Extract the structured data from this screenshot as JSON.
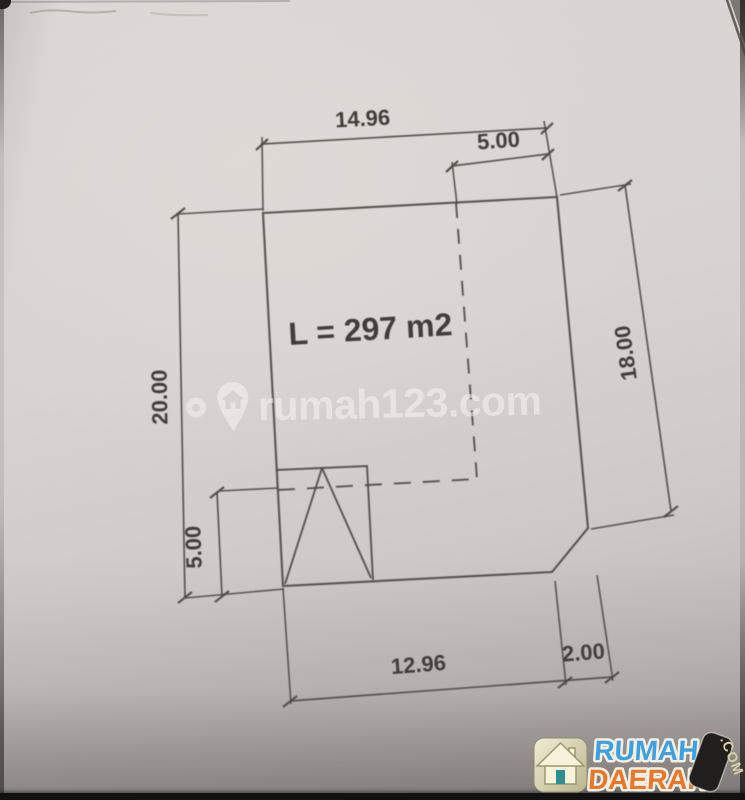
{
  "document": {
    "kind": "land-plot-technical-drawing-photo",
    "area_label": "L = 297 m2",
    "dimensions": {
      "top_width": "14.96",
      "top_right_inset": "5.00",
      "left_side": "20.00",
      "right_side": "18.00",
      "lower_left_height": "5.00",
      "bottom_width": "12.96",
      "bottom_chamfer": "2.00"
    }
  },
  "watermark": {
    "text": "rumah123.com",
    "icon": "map-pin-house-icon",
    "color": "rgba(250,248,246,0.50)"
  },
  "branding": {
    "badge_icon": "house-icon",
    "line1": "RUMAH",
    "line2": "DAERAH",
    "tag": ".COM",
    "colors": {
      "line1": "#3fa0dd",
      "line2": "#e8772a",
      "tag_bg": "#211f1d",
      "tag_text": "#d9cfa4",
      "outline": "#f2efe4"
    }
  },
  "ink_color": "#4e4a46",
  "paper_color": "#d6d1cf"
}
